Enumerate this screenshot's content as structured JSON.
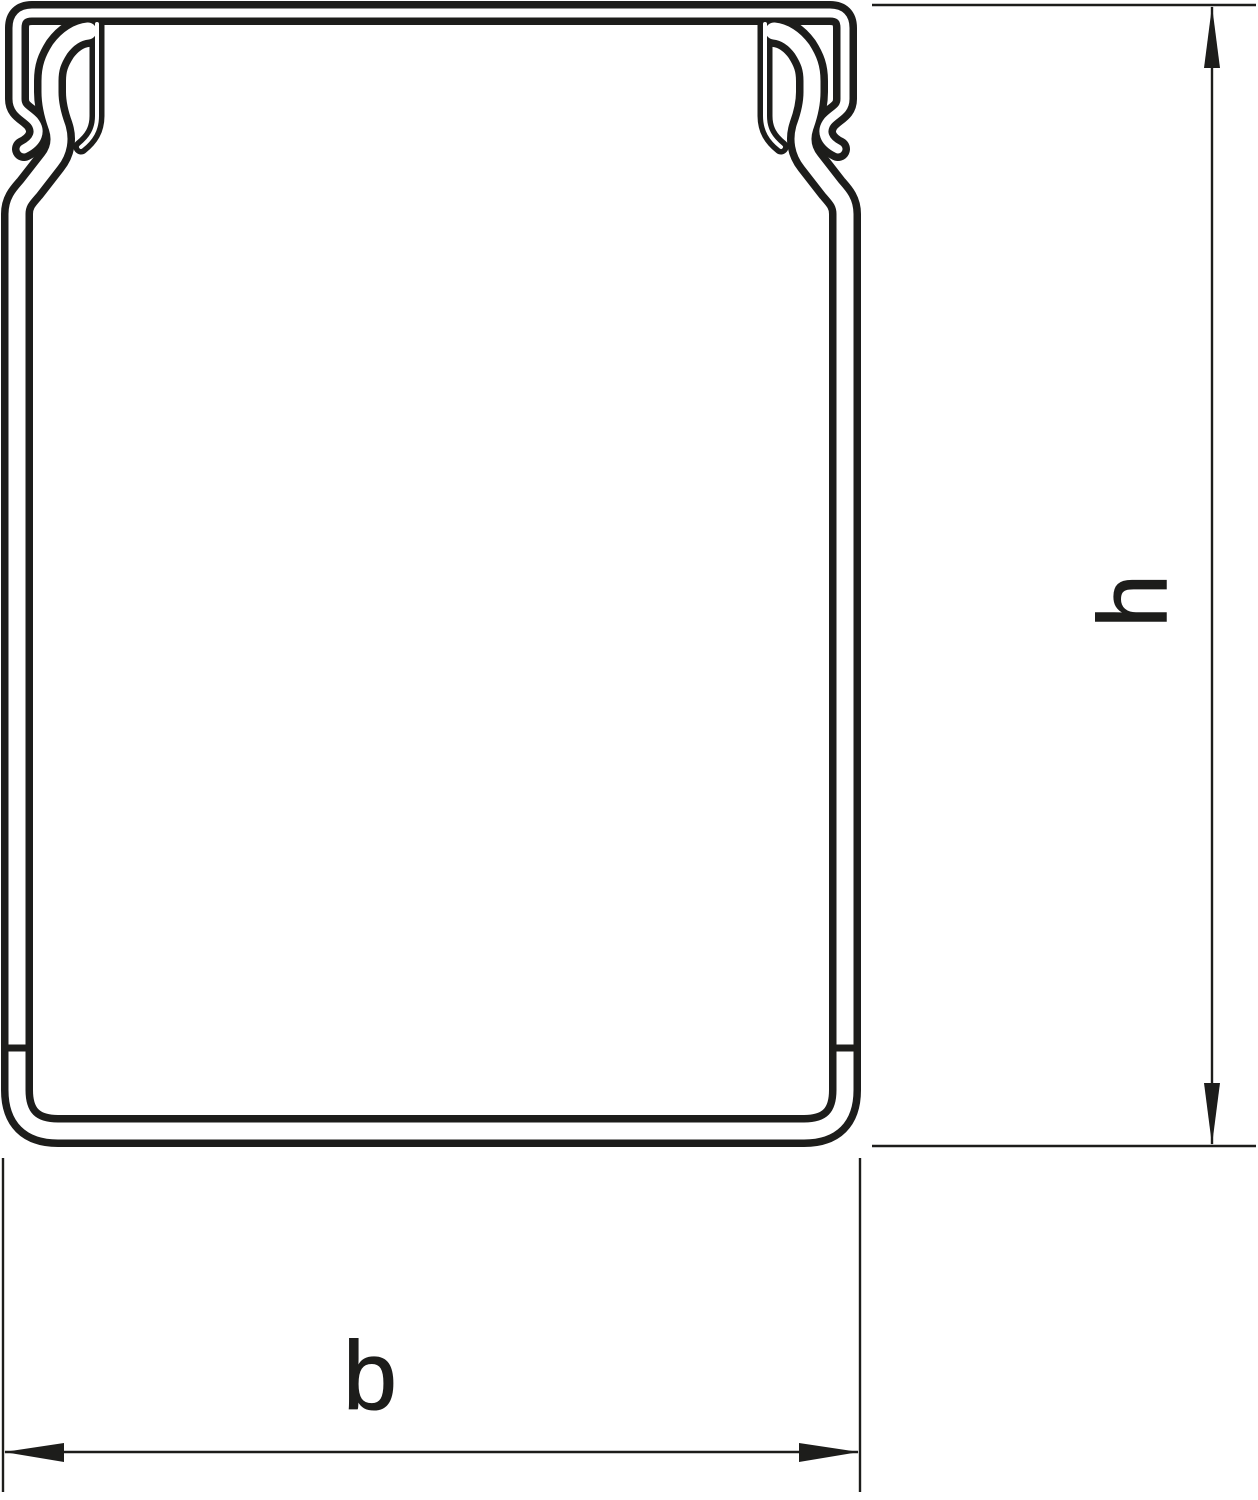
{
  "diagram": {
    "type": "technical-drawing",
    "subject": "cable-trunking-profile-cross-section",
    "dimension_labels": {
      "height": "h",
      "width": "b"
    },
    "colors": {
      "line": "#1d1d1b",
      "background": "#ffffff"
    }
  }
}
